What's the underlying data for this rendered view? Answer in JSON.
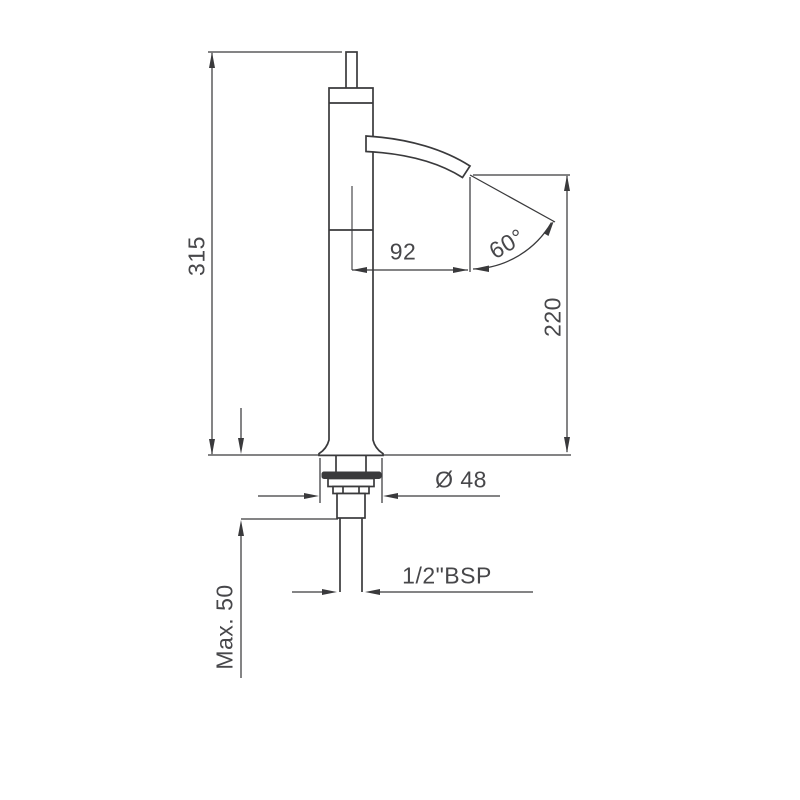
{
  "drawing": {
    "units": "mm",
    "line_color": "#3a3a3c",
    "text_color": "#47474a",
    "background_color": "#ffffff",
    "labels": {
      "overall_height": "315",
      "spout_reach": "92",
      "spout_angle": "60°",
      "outlet_height": "220",
      "base_diameter": "Ø 48",
      "thread": "1/2\"BSP",
      "max_thickness": "Max. 50"
    }
  }
}
